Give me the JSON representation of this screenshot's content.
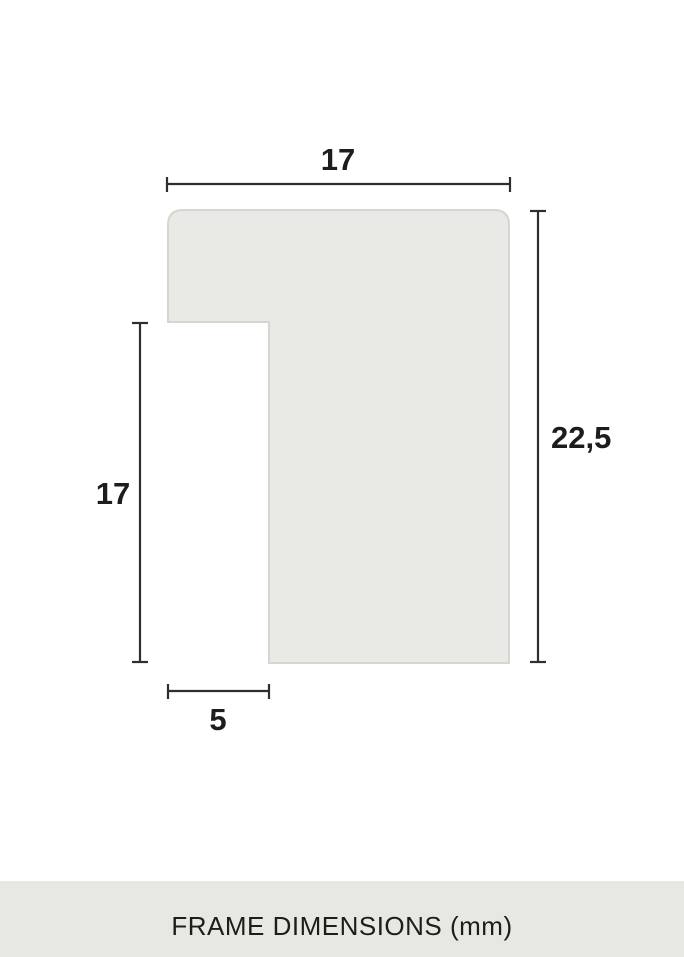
{
  "diagram": {
    "shape": "frame-profile-cross-section",
    "fill_color": "#e9e9e5",
    "stroke_color": "#d5d5d1",
    "dimension_line_color": "#2f2f2f",
    "label_color": "#1d1d1b",
    "unit": "mm",
    "dimensions": {
      "top_width": "17",
      "total_height": "22,5",
      "left_height": "17",
      "bottom_width": "5"
    }
  },
  "footer": {
    "caption": "FRAME DIMENSIONS (mm)",
    "background_color": "#e8e8e3"
  }
}
